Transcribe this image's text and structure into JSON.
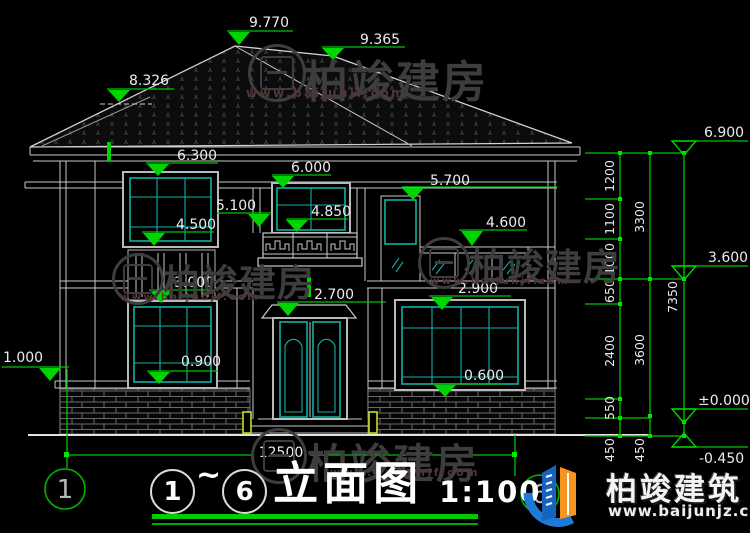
{
  "watermark": {
    "brand": "柏竣建房",
    "url": "www.baijunjf.com"
  },
  "logo": {
    "brand": "柏竣建筑",
    "url": "www.baijunjz.com"
  },
  "title": {
    "axis_from": "1",
    "separator": "~",
    "axis_to": "6",
    "name": "立面图",
    "scale": "1:100"
  },
  "axes": {
    "start": "1",
    "end": "6"
  },
  "levels": {
    "ridge_main": "9.770",
    "ridge_secondary": "9.365",
    "ridge_lower": "8.326",
    "eave": "6.300",
    "win_head_2f_center": "6.000",
    "band_2f_right": "5.700",
    "pier_left": "5.100",
    "balcony_sill": "4.850",
    "win_head_2f_right": "4.600",
    "win_sill_2f_left": "4.500",
    "win_head_1f_left": "3.000",
    "win_head_1f_right": "2.900",
    "door_head": "2.700",
    "base_band_left": "1.000",
    "win_sill_1f_left": "0.900",
    "win_sill_1f_right": "0.600"
  },
  "levels_right": {
    "eave": "6.900",
    "floor2": "3.600",
    "zero": "±0.000",
    "ground": "-0.450"
  },
  "dims": {
    "total_width": "12500",
    "chain_inner": [
      "1200",
      "1100",
      "1000",
      "650",
      "2400",
      "550",
      "450"
    ],
    "chain_mid": [
      "3300",
      "3600",
      "450"
    ],
    "chain_outer": [
      "7350"
    ]
  }
}
